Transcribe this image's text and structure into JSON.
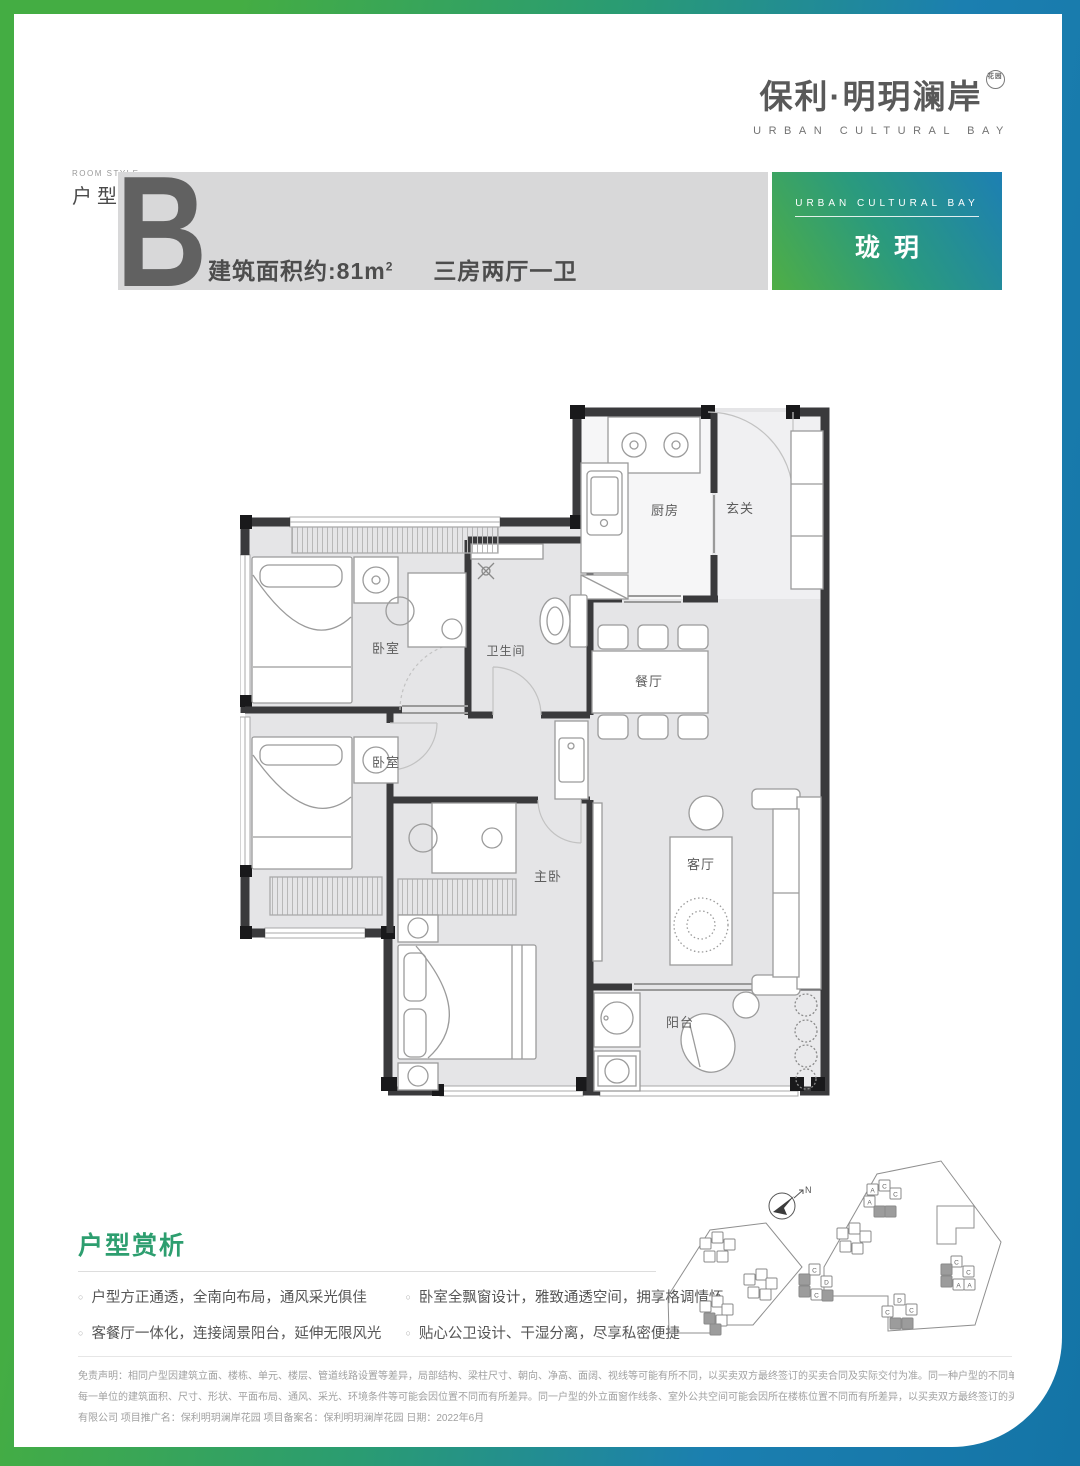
{
  "brand": {
    "logo_cn": "保利·明玥澜岸",
    "logo_seal": "花园",
    "logo_en": "URBAN CULTURAL BAY"
  },
  "unit": {
    "room_style_en": "ROOM STYLE",
    "room_style_cn": "户型",
    "letter": "B",
    "area_label": "建筑面积约:",
    "area_value": "81m",
    "area_sup": "2",
    "layout": "三房两厅一卫"
  },
  "badge": {
    "en": "URBAN CULTURAL BAY",
    "name": "珑玥"
  },
  "floorplan": {
    "rooms": {
      "kitchen": "厨房",
      "foyer": "玄关",
      "bathroom": "卫生间",
      "bedroom1": "卧室",
      "bedroom2": "卧室",
      "dining": "餐厅",
      "living": "客厅",
      "master": "主卧",
      "balcony": "阳台"
    }
  },
  "analysis": {
    "title": "户型赏析",
    "bullets": [
      "户型方正通透，全南向布局，通风采光俱佳",
      "卧室全飘窗设计，雅致通透空间，拥享格调情怀",
      "客餐厅一体化，连接阔景阳台，延伸无限风光",
      "贴心公卫设计、干湿分离，尽享私密便捷"
    ]
  },
  "siteplan": {
    "north": "N",
    "buildings": [
      [
        46,
        92,
        "",
        0
      ],
      [
        58,
        86,
        "",
        0
      ],
      [
        70,
        93,
        "",
        0
      ],
      [
        50,
        105,
        "",
        0
      ],
      [
        63,
        105,
        "",
        0
      ],
      [
        90,
        128,
        "",
        0
      ],
      [
        102,
        123,
        "",
        0
      ],
      [
        112,
        132,
        "",
        0
      ],
      [
        94,
        141,
        "",
        0
      ],
      [
        106,
        143,
        "",
        0
      ],
      [
        46,
        155,
        "",
        0
      ],
      [
        58,
        150,
        "",
        0
      ],
      [
        68,
        158,
        "",
        0
      ],
      [
        50,
        167,
        "",
        1
      ],
      [
        62,
        169,
        "",
        0
      ],
      [
        56,
        178,
        "",
        1
      ],
      [
        213,
        38,
        "A",
        0
      ],
      [
        225,
        34,
        "C",
        0
      ],
      [
        236,
        42,
        "C",
        0
      ],
      [
        210,
        50,
        "A",
        0
      ],
      [
        220,
        60,
        "",
        1
      ],
      [
        231,
        60,
        "",
        1
      ],
      [
        183,
        82,
        "",
        0
      ],
      [
        195,
        77,
        "",
        0
      ],
      [
        206,
        85,
        "",
        0
      ],
      [
        186,
        95,
        "",
        0
      ],
      [
        198,
        97,
        "",
        0
      ],
      [
        155,
        118,
        "C",
        0
      ],
      [
        145,
        128,
        "",
        1
      ],
      [
        145,
        140,
        "",
        1
      ],
      [
        167,
        130,
        "D",
        0
      ],
      [
        157,
        143,
        "C",
        0
      ],
      [
        168,
        144,
        "",
        1
      ],
      [
        297,
        110,
        "C",
        0
      ],
      [
        309,
        120,
        "C",
        0
      ],
      [
        287,
        118,
        "",
        1
      ],
      [
        287,
        130,
        "",
        1
      ],
      [
        299,
        133,
        "A",
        0
      ],
      [
        310,
        133,
        "A",
        0
      ],
      [
        240,
        148,
        "D",
        0
      ],
      [
        228,
        160,
        "C",
        0
      ],
      [
        252,
        158,
        "C",
        0
      ],
      [
        236,
        172,
        "",
        1
      ],
      [
        248,
        172,
        "",
        1
      ]
    ]
  },
  "disclaimer": {
    "lines": [
      "免责声明：相同户型因建筑立面、楼栋、单元、楼层、管道线路设置等差异，局部结构、梁柱尺寸、朝向、净高、面阔、视线等可能有所不同，以买卖双方最终签订的买卖合同及实际交付为准。同一种户型的不同单位的飘台、门窗、管道、剪力墙的厚度/尺寸/位置等可能不同，",
      "每一单位的建筑面积、尺寸、形状、平面布局、通风、采光、环境条件等可能会因位置不同而有所差异。同一户型的外立面窗作线条、室外公共空间可能会因所在楼栋位置不同而有所差异，以买卖双方最终签订的买卖合同及实际交付为准。开发商名称：深圳市保发展地产开发",
      "有限公司 项目推广名：保利明玥澜岸花园 项目备案名：保利明玥澜岸花园 日期：2022年6月"
    ]
  },
  "colors": {
    "frame_green": "#44ad43",
    "frame_blue": "#1b7fb0",
    "heading_teal": "#2d9e6f",
    "band_gray": "#d8d8d9"
  }
}
